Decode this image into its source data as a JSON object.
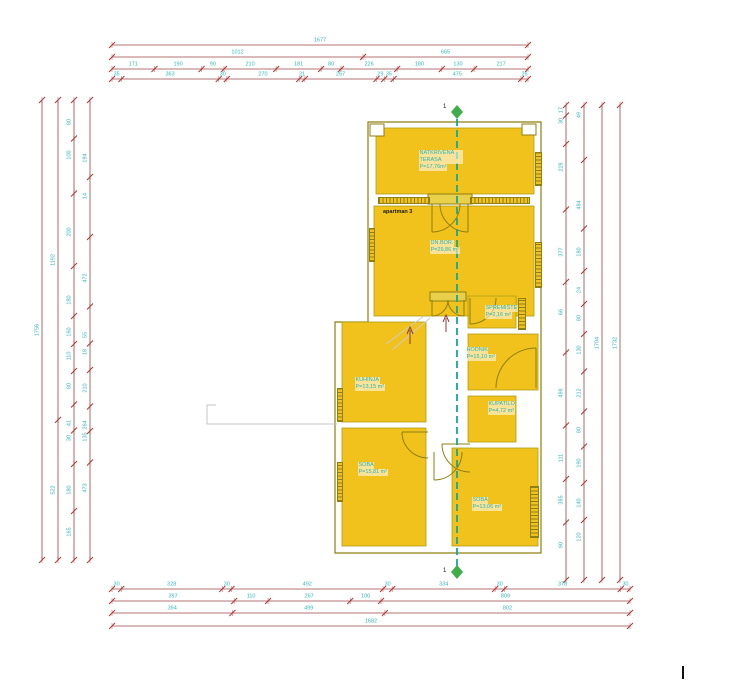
{
  "plan": {
    "apartment_label": "apartman 3",
    "rooms": {
      "terasa": {
        "name": "NATKRIVENA TERASA",
        "area": "P=17,76m²"
      },
      "dnevni": {
        "name": "DN.BOR.",
        "area": "P=29,86 m²"
      },
      "kuhinja": {
        "name": "KUHINJA",
        "area": "P=13,15 m²"
      },
      "spremiste": {
        "name": "SPREMIŠTE",
        "area": "P=2,16 m²"
      },
      "hodnik": {
        "name": "HODNIK",
        "area": "P=15,10 m²"
      },
      "kupatilo": {
        "name": "KUPATILO",
        "area": "P=4,72 m²"
      },
      "soba_lijevo": {
        "name": "SOBA",
        "area": "P=15,81 m²"
      },
      "soba_desno": {
        "name": "SOBA",
        "area": "P=13,06 m²"
      }
    },
    "section_marker": {
      "label": "1"
    }
  },
  "dimensions": {
    "top": {
      "total": [
        1677
      ],
      "subtotals": [
        1012,
        665
      ],
      "segments": [
        171,
        190,
        90,
        210,
        181,
        80,
        226,
        180,
        130,
        217
      ],
      "inner": [
        35,
        363,
        30,
        270,
        21,
        267,
        29,
        35,
        475,
        26
      ]
    },
    "bottom": {
      "axes": [
        30,
        328,
        30,
        492,
        30,
        334,
        30,
        378,
        30
      ],
      "rooms": [
        397,
        110,
        267,
        100,
        809
      ],
      "subtotals": [
        394,
        499,
        802
      ],
      "total": [
        1682
      ]
    },
    "left": {
      "total": [
        1756
      ],
      "subtotals": [
        1192,
        522
      ],
      "outer": [
        80,
        100,
        200,
        180,
        160,
        110,
        80,
        41,
        30,
        180,
        165
      ],
      "inner": [
        194,
        14,
        472,
        55,
        18,
        210,
        264,
        135,
        473
      ]
    },
    "right": {
      "outer": [
        17,
        30,
        228,
        377,
        66,
        498,
        111,
        385,
        90
      ],
      "inner": [
        49,
        484,
        180,
        24,
        80,
        130,
        212,
        80,
        190,
        140,
        120
      ],
      "total_a": [
        1704
      ],
      "total_b": [
        1732
      ]
    }
  },
  "colors": {
    "room_fill": "#f1c21b",
    "wall": "#8f7e10",
    "dim_line": "#9a4444",
    "dim_tick": "#b03434",
    "dim_text": "#35b6b6",
    "section_line": "#12a79b",
    "section_marker": "#3fae49"
  }
}
